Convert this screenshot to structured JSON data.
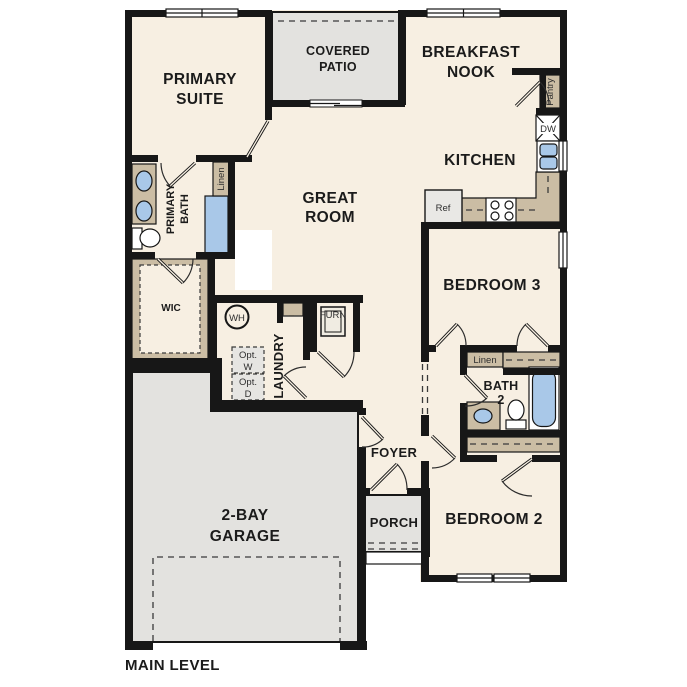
{
  "plan": {
    "title": "MAIN LEVEL",
    "rooms": {
      "primary_suite": {
        "l1": "PRIMARY",
        "l2": "SUITE"
      },
      "covered_patio": {
        "l1": "COVERED",
        "l2": "PATIO"
      },
      "breakfast_nook": {
        "l1": "BREAKFAST",
        "l2": "NOOK"
      },
      "kitchen": {
        "l1": "KITCHEN"
      },
      "great_room": {
        "l1": "GREAT",
        "l2": "ROOM"
      },
      "primary_bath": {
        "l1": "PRIMARY",
        "l2": "BATH"
      },
      "wic": {
        "l1": "WIC"
      },
      "laundry": {
        "l1": "LAUNDRY"
      },
      "bedroom_3": {
        "l1": "BEDROOM 3"
      },
      "bath_2": {
        "l1": "BATH",
        "l2": "2"
      },
      "foyer": {
        "l1": "FOYER"
      },
      "porch": {
        "l1": "PORCH"
      },
      "garage": {
        "l1": "2-BAY",
        "l2": "GARAGE"
      },
      "bedroom_2": {
        "l1": "BEDROOM 2"
      }
    },
    "fixtures": {
      "pantry": "Pantry",
      "linen_primary": "Linen",
      "linen_hall": "Linen",
      "fridge": "Ref",
      "dishwasher": "DW",
      "water_heater": "WH",
      "furnace": "FURN",
      "opt_washer": {
        "l1": "Opt.",
        "l2": "W"
      },
      "opt_dryer": {
        "l1": "Opt.",
        "l2": "D"
      }
    },
    "colors": {
      "floor": "#f7efe2",
      "hardscape": "#e3e2df",
      "casework": "#cbbda4",
      "fixture_blue": "#a9c8e8",
      "wall": "#171717"
    }
  }
}
